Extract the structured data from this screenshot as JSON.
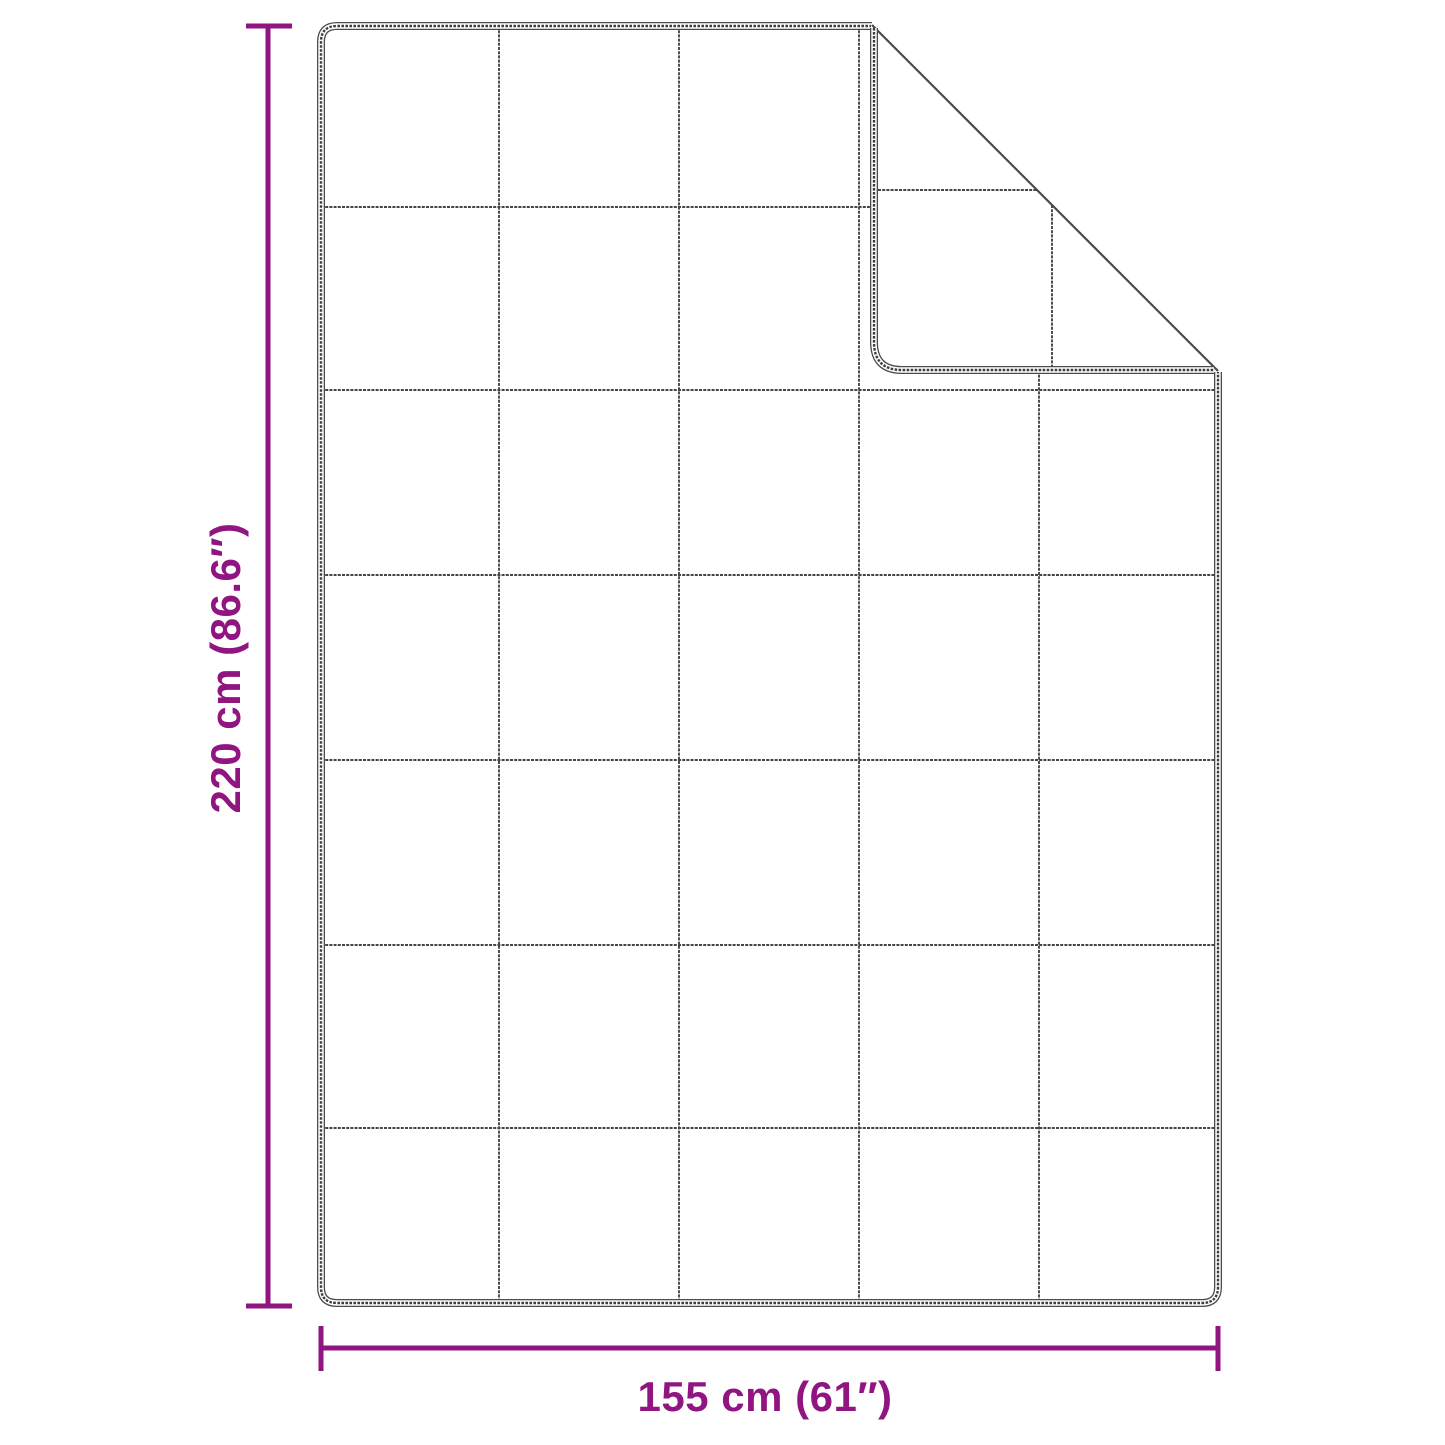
{
  "diagram": {
    "description": "Dimension diagram of a quilted blanket with a folded-over top-right corner",
    "height_dimension": {
      "label": "220 cm (86.6″)",
      "cm": 220,
      "inches": 86.6
    },
    "width_dimension": {
      "label": "155 cm (61″)",
      "cm": 155,
      "inches": 61
    },
    "quilt_grid": {
      "columns": 5,
      "rows": 7
    },
    "colors": {
      "dimension_accent": "#911580",
      "outline": "#4B4B4B",
      "background": "#FFFFFF"
    }
  }
}
